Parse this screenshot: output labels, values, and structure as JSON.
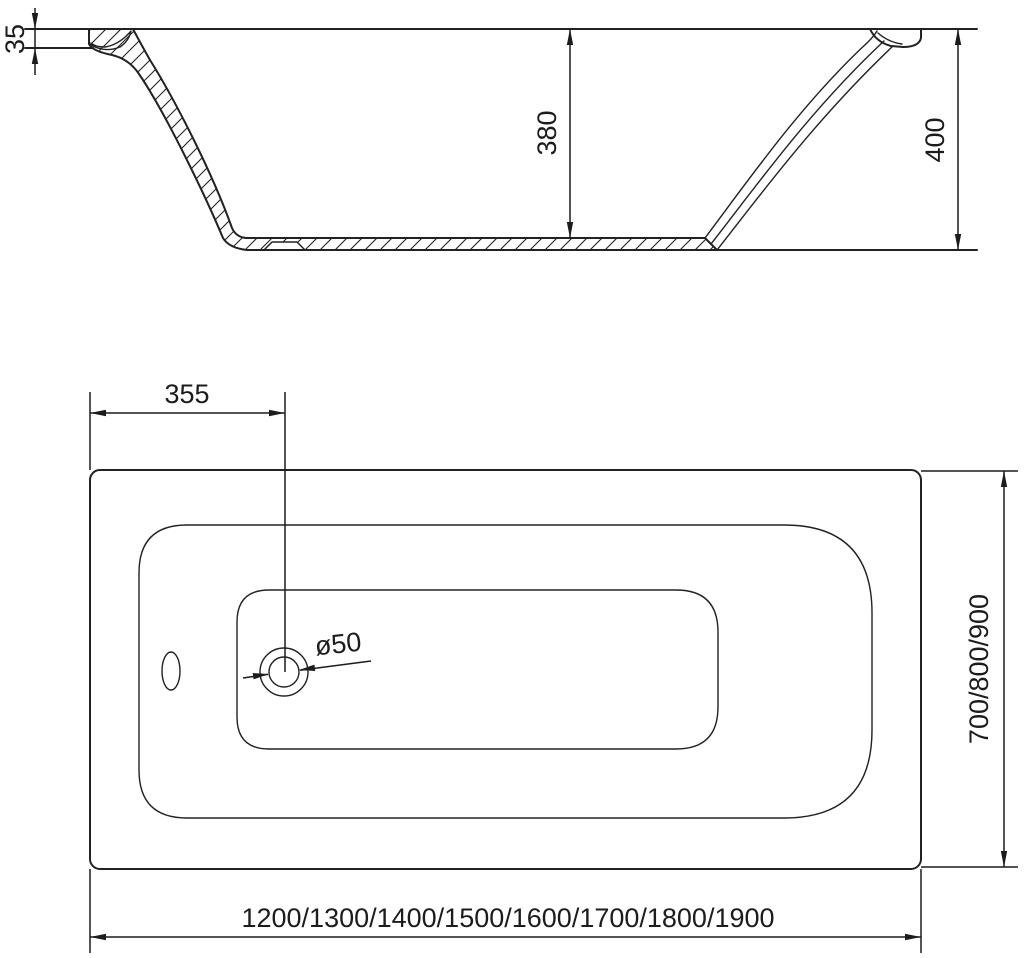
{
  "drawing": {
    "section_view": {
      "labels": {
        "rim_height": "35",
        "inner_depth": "380",
        "overall_height": "400"
      }
    },
    "plan_view": {
      "labels": {
        "drain_offset_from_left": "355",
        "drain_diameter": "ø50",
        "width_options": "700/800/900",
        "length_options": "1200/1300/1400/1500/1600/1700/1800/1900"
      }
    },
    "colors": {
      "line": "#222222",
      "background": "#ffffff"
    }
  }
}
